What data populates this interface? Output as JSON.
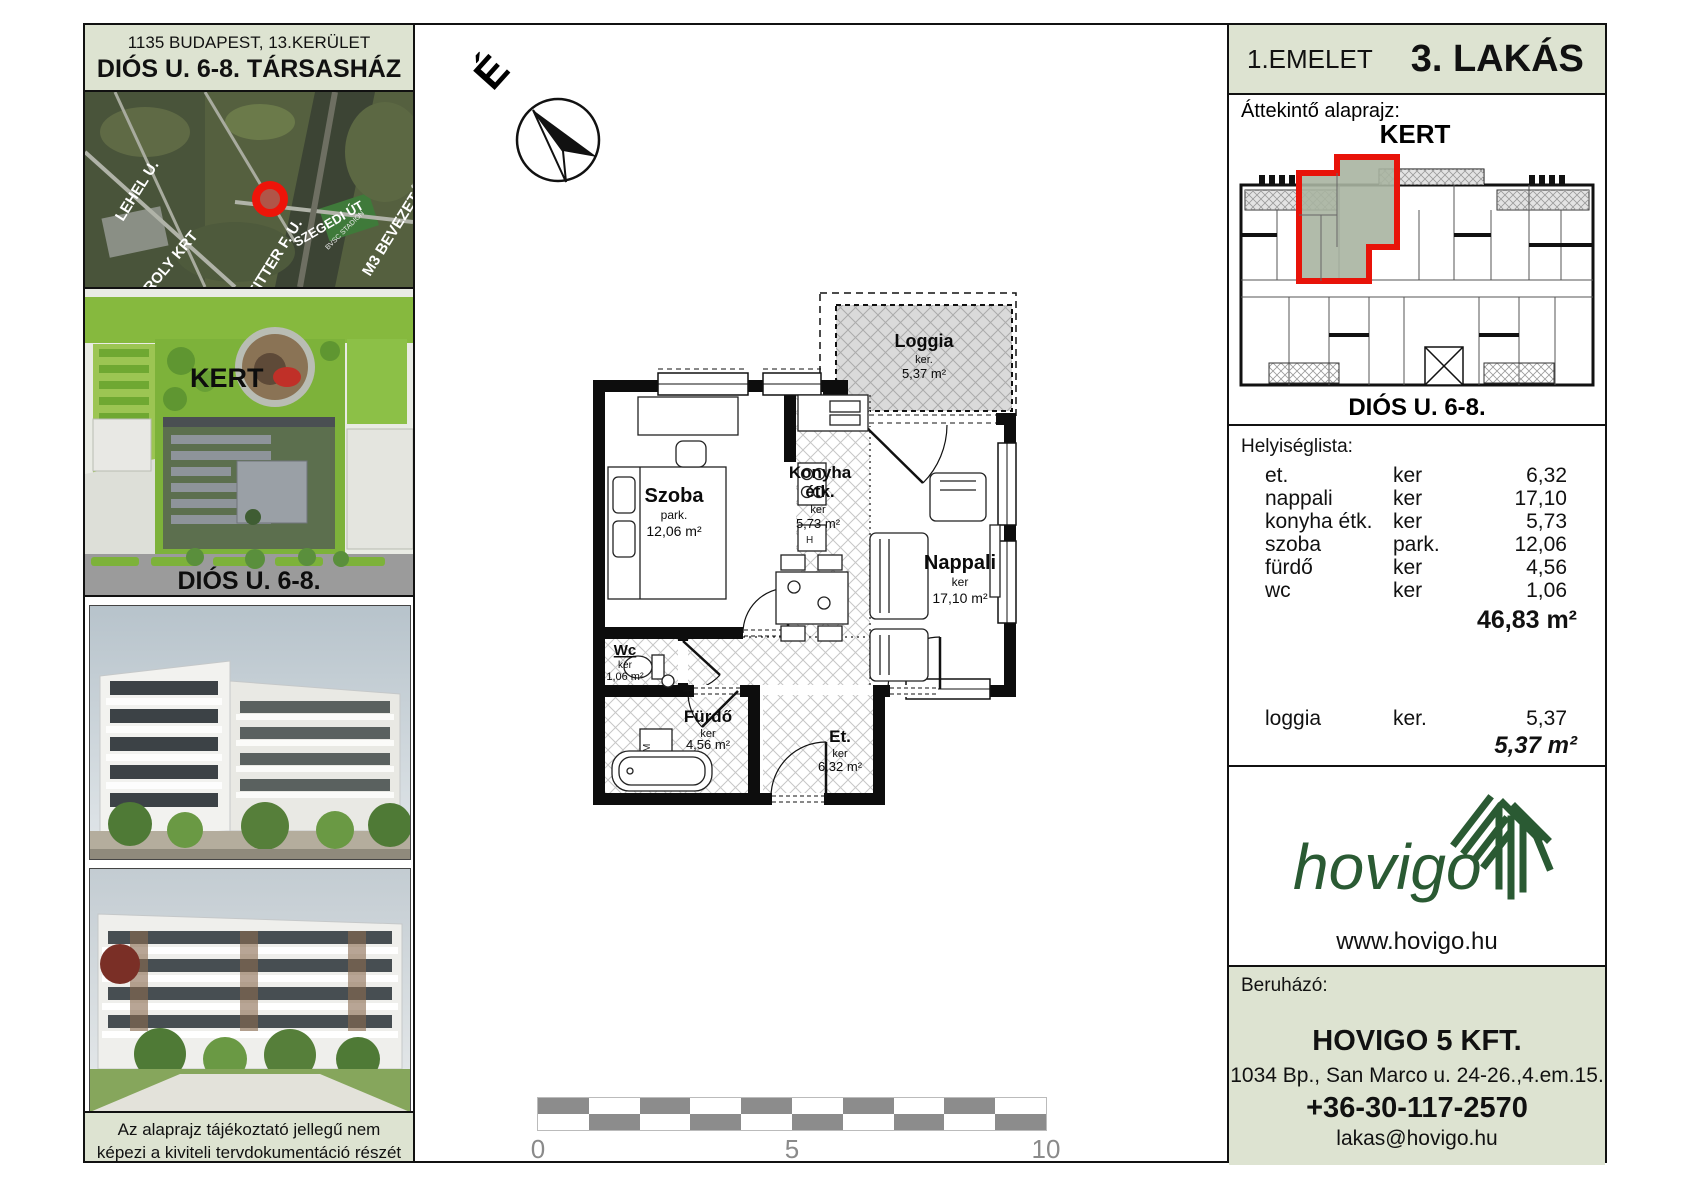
{
  "colors": {
    "panel_green": "#dde3d1",
    "brand_green": "#2a5a33",
    "highlight_red": "#e81309",
    "unit_fill": "#a9b4a1"
  },
  "left_column": {
    "header": {
      "line1": "1135 BUDAPEST, 13.KERÜLET",
      "line2": "DIÓS U. 6-8. TÁRSASHÁZ"
    },
    "map": {
      "street_labels": [
        "LEHEL U.",
        "RÓBERT KÁROLY KRT",
        "REITTER F. U.",
        "SZEGEDI ÚT",
        "M3 BEVEZETŐ",
        "BVSC STADION"
      ]
    },
    "garden": {
      "area_label": "KERT",
      "street_label": "DIÓS U. 6-8."
    },
    "disclaimer": {
      "line1": "Az alaprajz tájékoztató jellegű nem",
      "line2": "képezi a kiviteli tervdokumentáció részét"
    }
  },
  "center": {
    "compass_label": "É",
    "floorplan": {
      "rooms": [
        {
          "name": "Szoba",
          "finish": "park.",
          "area": "12,06 m²"
        },
        {
          "name": "Konyha",
          "name2": "étk.",
          "finish": "ker",
          "area": "5,73 m²"
        },
        {
          "name": "Loggia",
          "finish": "ker.",
          "area": "5,37 m²"
        },
        {
          "name": "Nappali",
          "finish": "ker",
          "area": "17,10 m²"
        },
        {
          "name": "Wc",
          "finish": "ker",
          "area": "1,06 m²"
        },
        {
          "name": "Fürdő",
          "finish": "ker",
          "area": "4,56 m²"
        },
        {
          "name": "Et.",
          "finish": "ker",
          "area": "6,32 m²"
        }
      ]
    },
    "scale_bar": {
      "labels": [
        "0",
        "5",
        "10"
      ]
    }
  },
  "right_column": {
    "header": {
      "floor": "1.EMELET",
      "unit": "3. LAKÁS"
    },
    "overview": {
      "title": "Áttekintő alaprajz:",
      "garden_label": "KERT",
      "street_label": "DIÓS U. 6-8."
    },
    "room_list": {
      "title": "Helyiséglista:",
      "rows": [
        {
          "name": "et.",
          "finish": "ker",
          "area": "6,32"
        },
        {
          "name": "nappali",
          "finish": "ker",
          "area": "17,10"
        },
        {
          "name": "konyha étk.",
          "finish": "ker",
          "area": "5,73"
        },
        {
          "name": "szoba",
          "finish": "park.",
          "area": "12,06"
        },
        {
          "name": "fürdő",
          "finish": "ker",
          "area": "4,56"
        },
        {
          "name": "wc",
          "finish": "ker",
          "area": "1,06"
        }
      ],
      "total": "46,83 m²",
      "loggia_row": {
        "name": "loggia",
        "finish": "ker.",
        "area": "5,37"
      },
      "loggia_total": "5,37 m²"
    },
    "logo": {
      "brand": "hovigo",
      "website": "www.hovigo.hu"
    },
    "developer": {
      "title": "Beruházó:",
      "company": "HOVIGO 5 KFT.",
      "address": "1034 Bp., San Marco u. 24-26.,4.em.15.",
      "phone": "+36-30-117-2570",
      "email": "lakas@hovigo.hu"
    }
  }
}
